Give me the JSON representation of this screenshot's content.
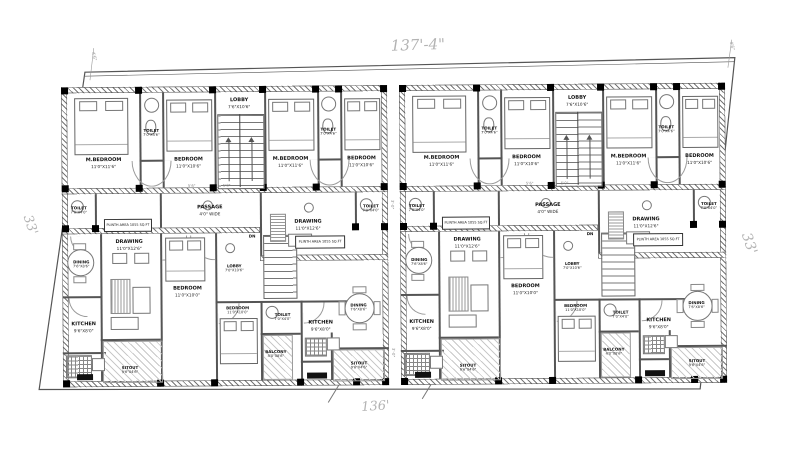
{
  "dims": {
    "top": "137'-4\"",
    "bottom": "136'",
    "side_left": "33'",
    "side_right": "33'",
    "gap_upper": "3'-0\"",
    "gap_lower": "3'-0\"",
    "tick_left": "4'6\"",
    "tick_right": "4'6\"",
    "passage_tick_1": "5'6\"",
    "passage_tick_2": "5'0\""
  },
  "rooms": {
    "m_bedroom": {
      "name": "M.BEDROOM",
      "size": "11'0\"X11'6\""
    },
    "toilet_top": {
      "name": "TOILET",
      "size": "7'0\"X4'6\""
    },
    "bedroom_top": {
      "name": "BEDROOM",
      "size": "11'0\"X10'6\""
    },
    "lobby": {
      "name": "LOBBY",
      "size": "7'6\"X10'6\""
    },
    "passage": {
      "name": "PASSAGE",
      "size": "4'0\" WIDE"
    },
    "toilet_mid": {
      "name": "TOILET",
      "size": "7'0\"X4'0\""
    },
    "drawing": {
      "name": "DRAWING",
      "size": "11'0\"X12'6\""
    },
    "dining": {
      "name": "DINING",
      "size": "7'6\"X8'6\""
    },
    "kitchen": {
      "name": "KITCHEN",
      "size": "9'6\"X8'0\""
    },
    "bedroom_lower": {
      "name": "BEDROOM",
      "size": "11'0\"X10'0\""
    },
    "lobby_lower": {
      "name": "LOBBY",
      "size": "7'0\"X10'6\""
    },
    "toilet_lower": {
      "name": "TOILET",
      "size": "7'0\"X4'0\""
    },
    "balcony": {
      "name": "BALCONY",
      "size": "4'0\"X8'6\""
    },
    "sitout": {
      "name": "SITOUT",
      "size": "9'6\"X4'6\""
    },
    "plinth_label": "PLINTH AREA 1055 SQ.FT",
    "dn_label": "DN"
  }
}
